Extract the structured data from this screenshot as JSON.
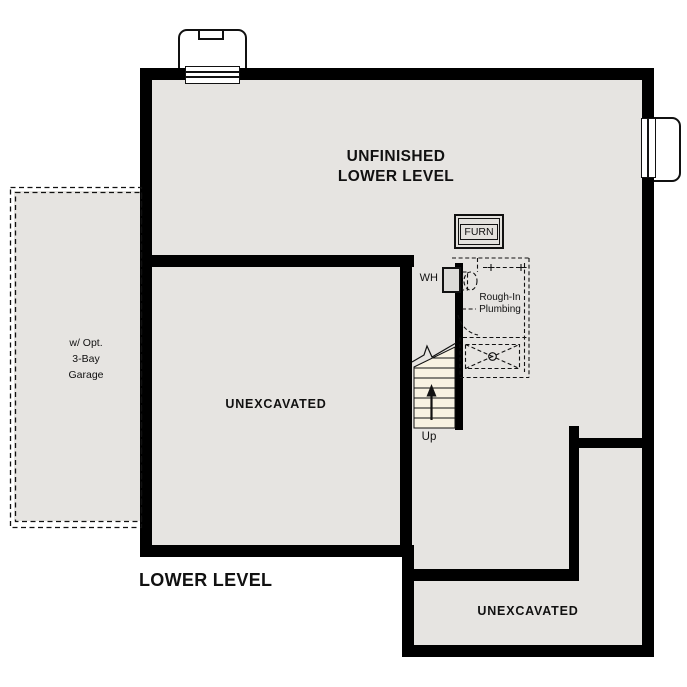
{
  "plan_title": "LOWER LEVEL",
  "colors": {
    "wall": "#000000",
    "floor_fill": "#e6e4e1",
    "stair_fill": "#f8f2e2",
    "background": "#ffffff"
  },
  "rooms": {
    "unfinished_lower_level": {
      "line1": "UNFINISHED",
      "line2": "LOWER LEVEL"
    },
    "unexcavated_left": {
      "label": "UNEXCAVATED"
    },
    "unexcavated_bottom_right": {
      "label": "UNEXCAVATED"
    },
    "optional_garage": {
      "line1": "w/ Opt.",
      "line2": "3-Bay",
      "line3": "Garage"
    }
  },
  "fixtures": {
    "furnace": {
      "label": "FURN"
    },
    "water_heater": {
      "label": "WH"
    },
    "rough_in_plumbing": {
      "line1": "Rough-In",
      "line2": "Plumbing"
    },
    "stairs": {
      "direction_label": "Up"
    }
  }
}
